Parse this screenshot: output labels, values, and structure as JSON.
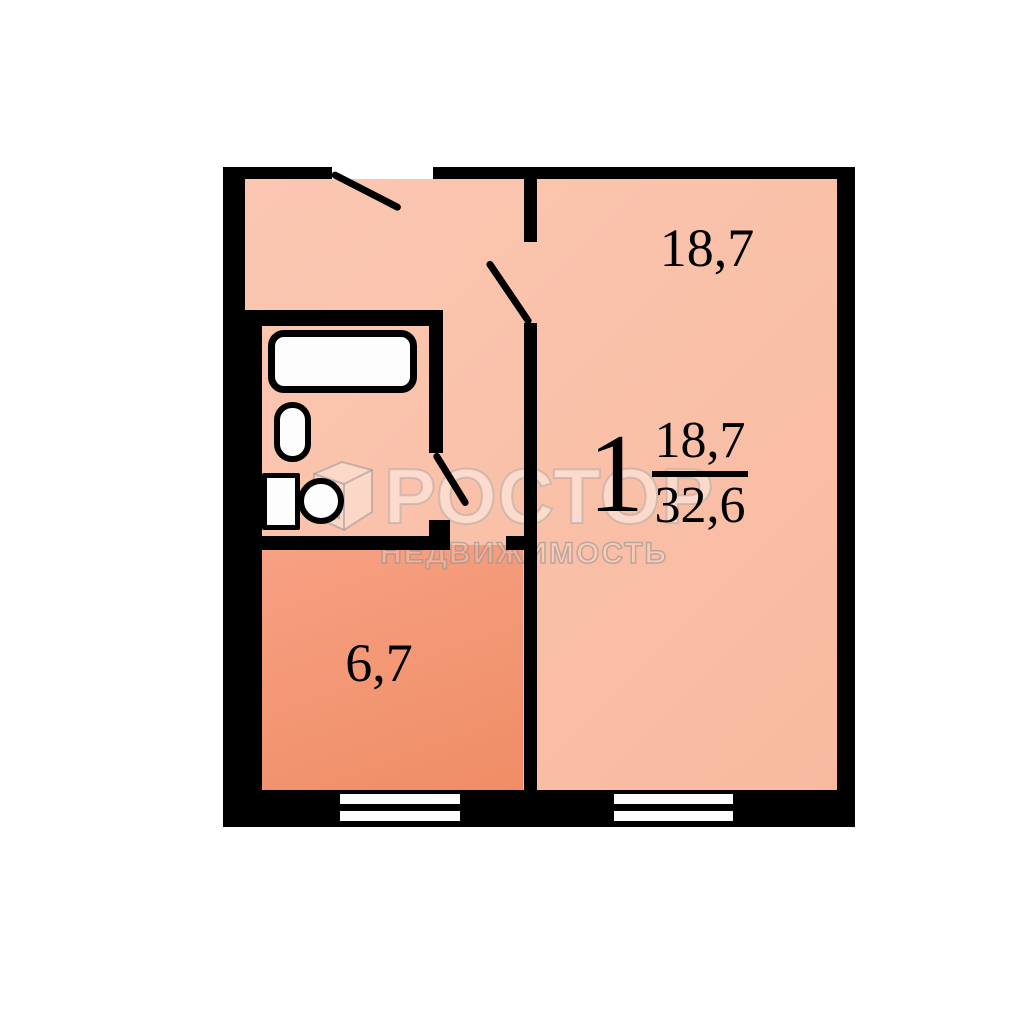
{
  "plan": {
    "apartment": {
      "rooms_count": "1",
      "living_area": "18,7",
      "total_area": "32,6"
    },
    "living_room": {
      "area": "18,7"
    },
    "kitchen": {
      "area": "6,7"
    },
    "fixtures": [
      "bathtub-icon",
      "sink-icon",
      "toilet-icon"
    ],
    "windows": [
      "kitchen-window",
      "living-room-window"
    ],
    "doors": [
      "entrance-door-leaf",
      "living-room-door-leaf",
      "bathroom-door-leaf"
    ]
  },
  "watermark": {
    "icon": "prostor-logo-icon",
    "brand_letters": "РОСТОР",
    "tagline": "НЕДВИЖИМОСТЬ"
  },
  "colors": {
    "background": "#ffffff",
    "wall": "#000000",
    "room_light": "#fbc7b2",
    "room_light_deep": "#f8ba9f",
    "kitchen": "#f7a183",
    "kitchen_deep": "#ef8d66",
    "fixture_fill": "#fdfdfd",
    "watermark_fill": "rgba(255,255,255,0.42)",
    "watermark_stroke": "rgba(160,160,160,0.45)"
  }
}
